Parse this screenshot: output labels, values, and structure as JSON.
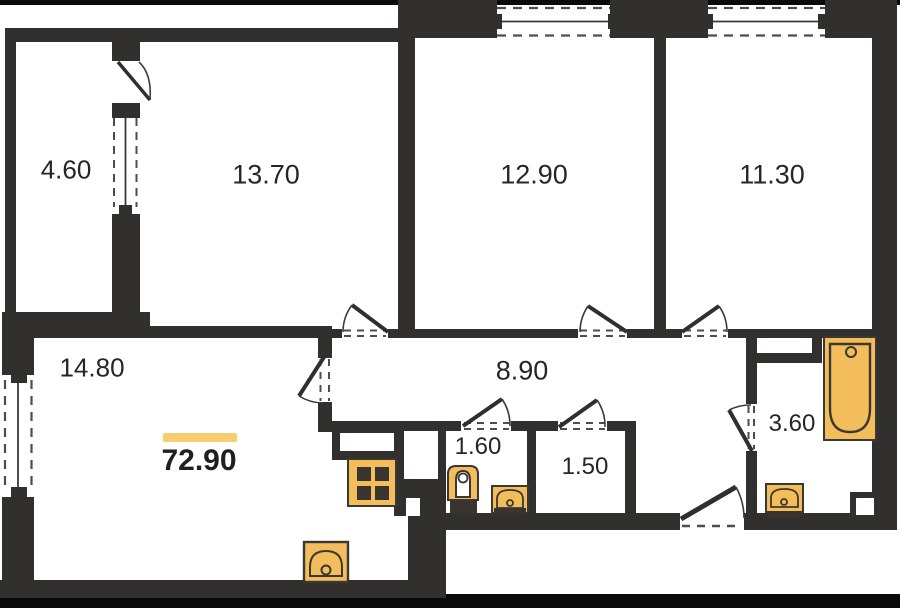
{
  "plan": {
    "type": "apartment-floor-plan",
    "total_area": "72.90",
    "rooms": [
      {
        "name": "balcony",
        "area": "4.60"
      },
      {
        "name": "bedroom-left",
        "area": "13.70"
      },
      {
        "name": "bedroom-middle",
        "area": "12.90"
      },
      {
        "name": "bedroom-right",
        "area": "11.30"
      },
      {
        "name": "living-room",
        "area": "14.80"
      },
      {
        "name": "hallway",
        "area": "8.90"
      },
      {
        "name": "wc",
        "area": "1.60"
      },
      {
        "name": "storage",
        "area": "1.50"
      },
      {
        "name": "bathroom",
        "area": "3.60"
      }
    ],
    "fixtures": [
      "bathtub",
      "stove",
      "kitchen-sink",
      "toilet",
      "wc-sink",
      "bathroom-sink",
      "vent-duct"
    ],
    "colors": {
      "wall": "#31302E",
      "photo_border": "#0A0A0A",
      "fixture_fill": "#F4BD5C",
      "fixture_stroke": "#3B3834",
      "highlight_bar": "#F8CC70",
      "text": "#262626",
      "background": "#FFFFFF"
    }
  }
}
